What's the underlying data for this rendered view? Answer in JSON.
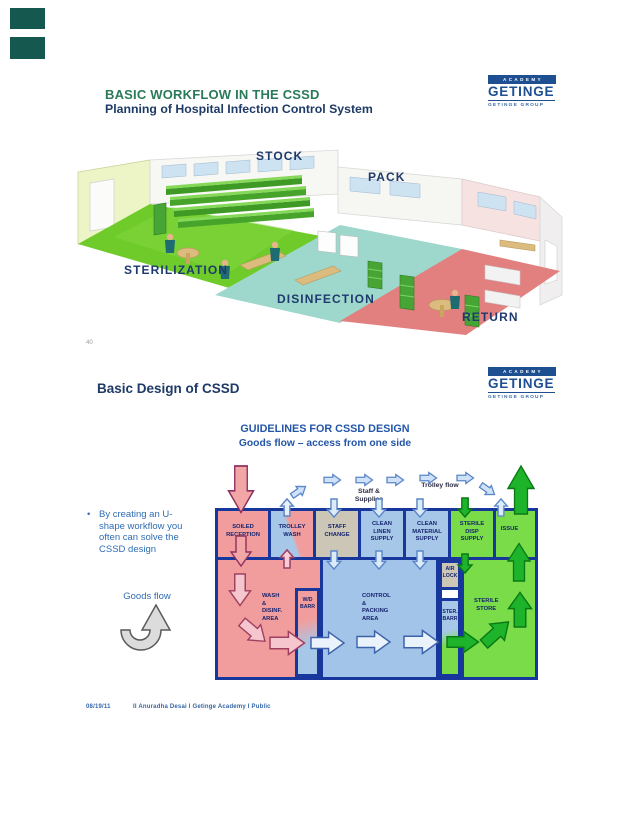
{
  "page": {
    "slide_number": "40",
    "footer": {
      "date": "08/19/11",
      "credit": "II Anuradha Desai I Getinge Academy I Public"
    }
  },
  "logo": {
    "academy": "ACADEMY",
    "name": "GETINGE",
    "group": "GETINGE GROUP"
  },
  "slide1": {
    "title": "BASIC WORKFLOW IN THE CSSD",
    "subtitle": "Planning of Hospital Infection Control System",
    "labels": {
      "stock": "STOCK",
      "pack": "PACK",
      "sterilization": "STERILIZATION",
      "disinfection": "DISINFECTION",
      "return": "RETURN"
    }
  },
  "slide2": {
    "title": "Basic Design of CSSD",
    "diagram": {
      "title": "GUIDELINES FOR CSSD DESIGN",
      "subtitle": "Goods flow – access from one side",
      "bullet": "By creating an U-shape workflow you often can solve the CSSD design",
      "goods_flow": "Goods flow",
      "staff_supplies": "Staff & Supplies",
      "trolley_flow": "Trolley flow",
      "rooms": {
        "soiled_reception": "SOILED\nRECEPTION",
        "trolley_wash": "TROLLEY\nWASH",
        "staff_change": "STAFF\nCHANGE",
        "clean_linen": "CLEAN\nLINEN\nSUPPLY",
        "clean_material": "CLEAN\nMATERIAL\nSUPPLY",
        "sterile_disp": "STERILE\nDISP\nSUPPLY",
        "issue": "ISSUE",
        "wash_disinf": "WASH\n&\nDISINF.\nAREA",
        "wd_barr": "W/D\nBARR",
        "control_packing": "CONTROL\n&\nPACKING\nAREA",
        "air_lock": "AIR\nLOCK",
        "ster_barr": "STER.\nBARR",
        "sterile_store": "STERILE\nSTORE"
      }
    }
  },
  "colors": {
    "wall_navy": "#17379c",
    "room_pink": "#f29d9d",
    "room_blue": "#a7c7e9",
    "room_green": "#79dc48",
    "room_gray": "#cbc6b6",
    "arrow_green": "#1db32a",
    "title_green": "#2a7a5a",
    "title_navy": "#1e3a66",
    "accent_blue": "#2456a8",
    "logo_blue": "#1d4f91"
  }
}
